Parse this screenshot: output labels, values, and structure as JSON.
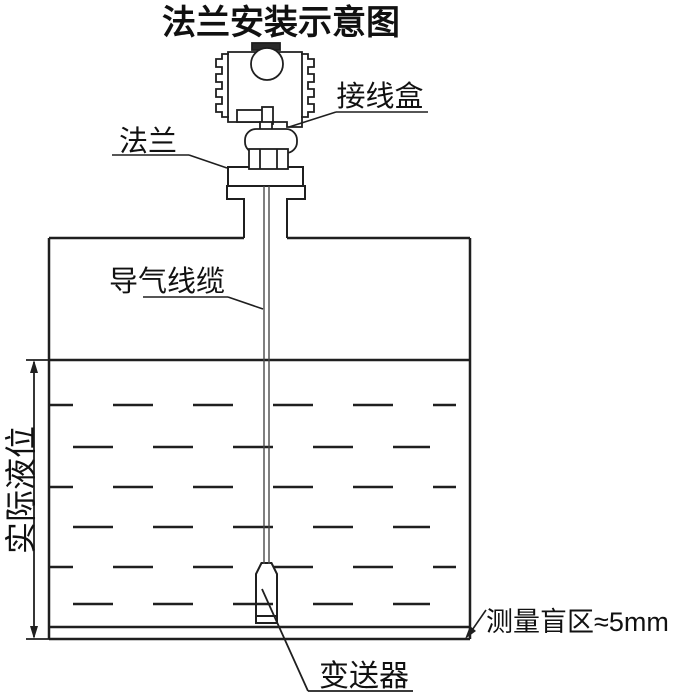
{
  "title": "法兰安装示意图",
  "labels": {
    "junction_box": "接线盒",
    "flange": "法兰",
    "air_cable": "导气线缆",
    "actual_level": "实际液位",
    "transmitter": "变送器",
    "blind_zone": "测量盲区≈5mm"
  },
  "colors": {
    "line": "#1f1f1f",
    "background": "#ffffff",
    "text": "#111111"
  }
}
